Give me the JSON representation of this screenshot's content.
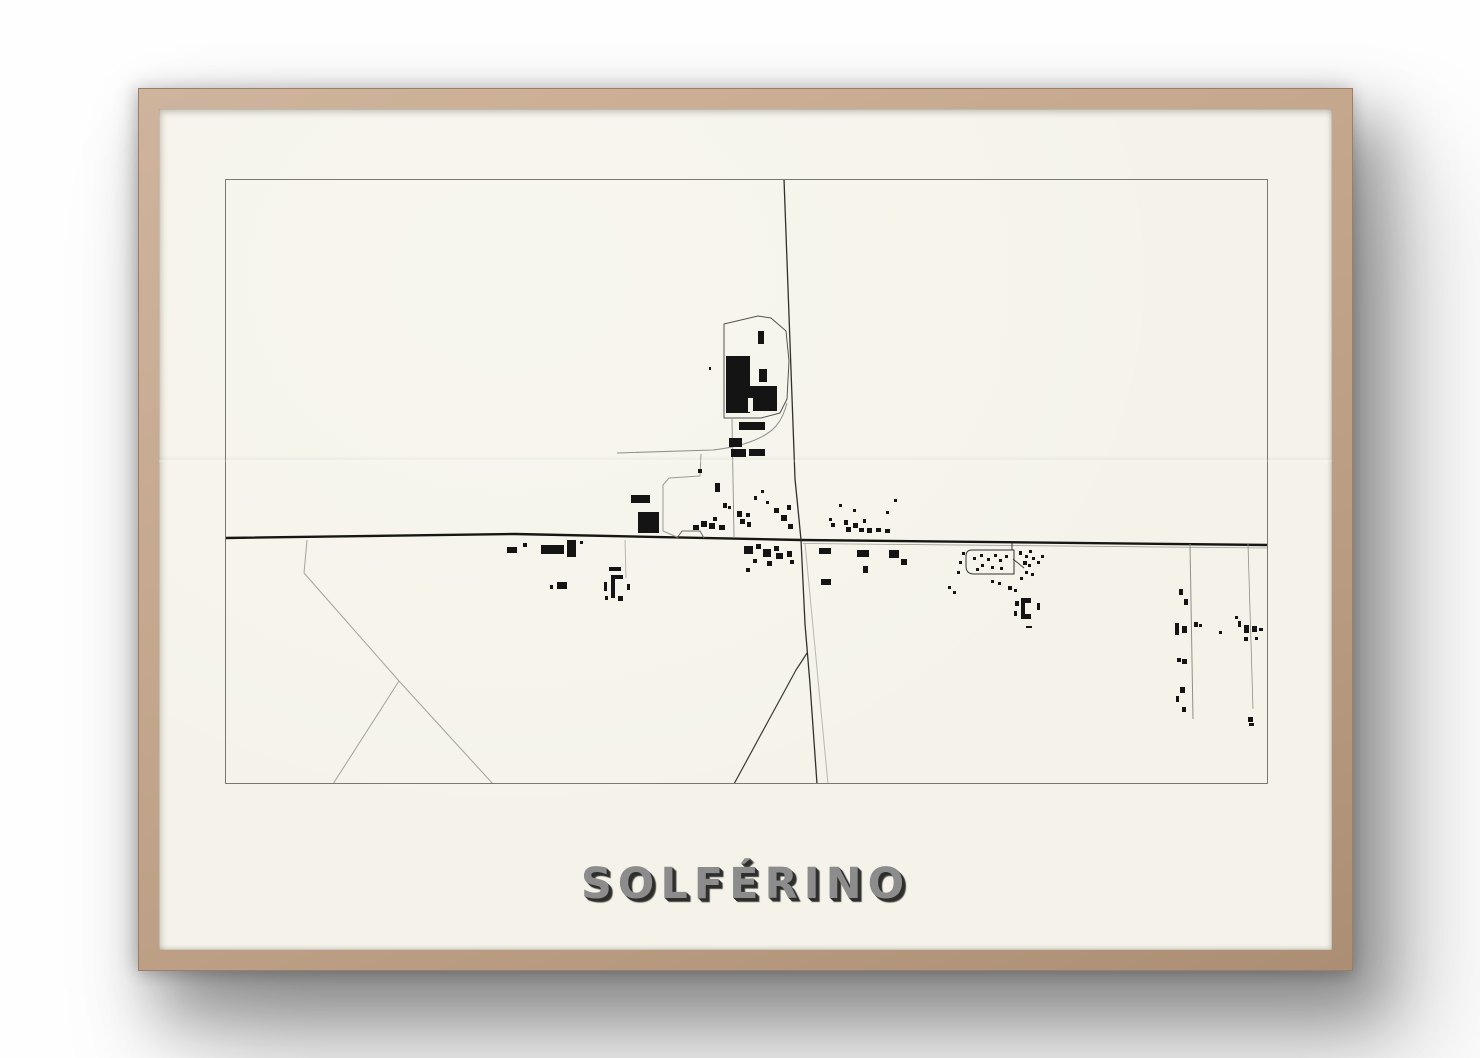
{
  "poster": {
    "title": "SOLFÉRINO"
  },
  "colors": {
    "background": "#fefefe",
    "frame_wood": "#c4a78c",
    "paper": "#f5f3e9",
    "map_border": "#7a786e",
    "road_dark": "#161613",
    "building": "#141414",
    "title_text": "#8c8c8c",
    "title_shadow": "#2e2e2c"
  },
  "map": {
    "viewbox": "0 0 1043 605",
    "paper_color": "#f5f3e9",
    "building_color": "#141414",
    "roads": [
      {
        "d": "M0,359 L290,355 L576,361 L1043,366",
        "c": "#161613",
        "w": 2.4
      },
      {
        "d": "M578,364.5 L1043,369",
        "c": "#a2a29a",
        "w": 0.8
      },
      {
        "d": "M559,0 L570,300 L573,330 L576,361",
        "c": "#30302c",
        "w": 1.3
      },
      {
        "d": "M576,361 L580,445 L585,505 L592,605",
        "c": "#30302c",
        "w": 1.3
      },
      {
        "d": "M582,474 Q577,482 571,491 L509,605",
        "c": "#3a3a35",
        "w": 1.2
      },
      {
        "d": "M580,364 L603,605",
        "c": "#b8b8b0",
        "w": 1
      },
      {
        "d": "M82,361 L79,394 L174,502 L268,605",
        "c": "#a3a399",
        "w": 1
      },
      {
        "d": "M174,502 L108,605",
        "c": "#a3a399",
        "w": 1
      },
      {
        "d": "M392,274 L488,271 C515,268 540,260 551,247 C557,240 560,232 562,224",
        "c": "#90908a",
        "w": 1
      },
      {
        "d": "M507,240 L509,359",
        "c": "#90908a",
        "w": 0.9
      },
      {
        "d": "M476,275 L475,297 L444,299 L438,306 L438,352 L452,358",
        "c": "#9c9b91",
        "w": 1
      },
      {
        "d": "M787,364 L787,371",
        "c": "#33332f",
        "w": 1
      },
      {
        "d": "M788,380 L799,389",
        "c": "#33332f",
        "w": 0.9
      },
      {
        "d": "M965,365 L968,540",
        "c": "#8f8f87",
        "w": 1
      },
      {
        "d": "M1023,365 L1028,530",
        "c": "#8f8f87",
        "w": 0.8
      },
      {
        "d": "M400,361 L401,399",
        "c": "#b0b0a8",
        "w": 0.9
      }
    ],
    "outlines": [
      {
        "d": "M0.5,0.5 H1042.5 V604.5 H0.5 Z",
        "c": "#7a786e",
        "w": 1
      },
      {
        "d": "M499,145 L533,137 L546,139 L561,152 L564,182 L562,220 L555,234 L536,239 L499,239 Z",
        "c": "#55534d",
        "w": 1
      },
      {
        "d": "M747,371 L789,371 L789,395 L749,395 Q741,395 741,387 L741,377 Q741,371 747,371 Z",
        "c": "#33332f",
        "w": 1
      },
      {
        "d": "M452,359 L457,352 L475,352 L479,359",
        "c": "#6a6a64",
        "w": 1
      }
    ],
    "shapes": [
      {
        "d": "M806,419 L796,419 L796,440 L806,440 L806,435 L800,435 L800,424 L806,424 Z"
      }
    ],
    "buildings": [
      [
        501,
        177,
        24,
        57
      ],
      [
        525,
        207,
        27,
        25
      ],
      [
        533,
        152,
        6,
        13
      ],
      [
        534,
        190,
        8,
        13
      ],
      [
        514,
        243,
        26,
        8
      ],
      [
        504,
        259,
        13,
        9
      ],
      [
        506,
        270,
        15,
        8
      ],
      [
        524,
        270,
        16,
        7
      ],
      [
        406,
        316,
        19,
        8
      ],
      [
        413,
        333,
        21,
        21
      ],
      [
        490,
        304,
        5,
        9
      ],
      [
        468,
        346,
        6,
        5
      ],
      [
        476,
        342,
        6,
        6
      ],
      [
        484,
        344,
        6,
        6
      ],
      [
        488,
        338,
        4,
        4
      ],
      [
        494,
        346,
        6,
        5
      ],
      [
        498,
        324,
        4,
        5
      ],
      [
        503,
        327,
        3,
        3
      ],
      [
        512,
        332,
        5,
        6
      ],
      [
        515,
        340,
        5,
        5
      ],
      [
        521,
        334,
        4,
        4
      ],
      [
        522,
        343,
        4,
        5
      ],
      [
        529,
        317,
        3,
        4
      ],
      [
        536,
        311,
        3,
        3
      ],
      [
        541,
        322,
        3,
        3
      ],
      [
        549,
        329,
        5,
        5
      ],
      [
        556,
        336,
        6,
        6
      ],
      [
        562,
        326,
        4,
        5
      ],
      [
        563,
        345,
        5,
        5
      ],
      [
        473,
        290,
        4,
        4
      ],
      [
        484,
        188,
        2,
        3
      ],
      [
        604,
        339,
        3,
        3
      ],
      [
        606,
        344,
        4,
        4
      ],
      [
        614,
        325,
        3,
        3
      ],
      [
        619,
        341,
        4,
        5
      ],
      [
        621,
        348,
        5,
        5
      ],
      [
        628,
        330,
        3,
        3
      ],
      [
        628,
        344,
        5,
        5
      ],
      [
        634,
        349,
        5,
        4
      ],
      [
        638,
        340,
        3,
        4
      ],
      [
        642,
        349,
        5,
        5
      ],
      [
        651,
        349,
        5,
        4
      ],
      [
        660,
        350,
        5,
        4
      ],
      [
        669,
        320,
        3,
        3
      ],
      [
        661,
        332,
        3,
        3
      ],
      [
        519,
        367,
        9,
        8
      ],
      [
        531,
        365,
        5,
        5
      ],
      [
        538,
        370,
        8,
        8
      ],
      [
        549,
        367,
        5,
        5
      ],
      [
        551,
        374,
        7,
        6
      ],
      [
        542,
        382,
        5,
        5
      ],
      [
        528,
        380,
        4,
        4
      ],
      [
        521,
        389,
        4,
        4
      ],
      [
        562,
        372,
        5,
        6
      ],
      [
        565,
        381,
        4,
        4
      ],
      [
        594,
        369,
        12,
        6
      ],
      [
        632,
        371,
        12,
        7
      ],
      [
        664,
        371,
        10,
        8
      ],
      [
        676,
        380,
        6,
        6
      ],
      [
        638,
        387,
        5,
        7
      ],
      [
        596,
        400,
        10,
        6
      ],
      [
        282,
        368,
        10,
        6
      ],
      [
        298,
        364,
        4,
        4
      ],
      [
        316,
        366,
        23,
        9
      ],
      [
        342,
        361,
        9,
        17
      ],
      [
        355,
        362,
        3,
        3
      ],
      [
        332,
        403,
        10,
        7
      ],
      [
        325,
        406,
        3,
        4
      ],
      [
        384,
        388,
        12,
        4
      ],
      [
        379,
        403,
        3,
        9
      ],
      [
        402,
        405,
        3,
        6
      ],
      [
        380,
        417,
        3,
        4
      ],
      [
        393,
        417,
        5,
        5
      ],
      [
        386,
        396,
        4,
        23
      ],
      [
        386,
        396,
        12,
        4
      ],
      [
        748,
        378,
        3,
        3
      ],
      [
        755,
        375,
        3,
        3
      ],
      [
        762,
        379,
        3,
        3
      ],
      [
        769,
        375,
        3,
        3
      ],
      [
        774,
        380,
        3,
        3
      ],
      [
        780,
        376,
        3,
        3
      ],
      [
        756,
        385,
        3,
        3
      ],
      [
        766,
        387,
        3,
        3
      ],
      [
        775,
        388,
        3,
        3
      ],
      [
        751,
        389,
        3,
        3
      ],
      [
        737,
        373,
        3,
        3
      ],
      [
        734,
        382,
        3,
        3
      ],
      [
        732,
        392,
        3,
        3
      ],
      [
        794,
        372,
        3,
        4
      ],
      [
        800,
        376,
        3,
        3
      ],
      [
        804,
        371,
        3,
        3
      ],
      [
        798,
        382,
        4,
        4
      ],
      [
        803,
        385,
        3,
        3
      ],
      [
        807,
        378,
        3,
        3
      ],
      [
        800,
        392,
        3,
        3
      ],
      [
        806,
        394,
        3,
        3
      ],
      [
        795,
        398,
        3,
        3
      ],
      [
        812,
        382,
        3,
        3
      ],
      [
        816,
        376,
        3,
        3
      ],
      [
        783,
        407,
        4,
        4
      ],
      [
        789,
        410,
        3,
        3
      ],
      [
        773,
        403,
        3,
        3
      ],
      [
        766,
        401,
        3,
        3
      ],
      [
        723,
        407,
        3,
        3
      ],
      [
        728,
        412,
        3,
        3
      ],
      [
        790,
        422,
        4,
        5
      ],
      [
        789,
        432,
        3,
        5
      ],
      [
        812,
        424,
        3,
        7
      ],
      [
        801,
        447,
        6,
        2
      ],
      [
        954,
        410,
        4,
        6
      ],
      [
        959,
        420,
        4,
        6
      ],
      [
        950,
        444,
        4,
        12
      ],
      [
        957,
        447,
        5,
        7
      ],
      [
        969,
        443,
        4,
        5
      ],
      [
        974,
        445,
        3,
        3
      ],
      [
        994,
        452,
        3,
        3
      ],
      [
        952,
        479,
        4,
        4
      ],
      [
        957,
        480,
        5,
        5
      ],
      [
        955,
        508,
        5,
        6
      ],
      [
        951,
        517,
        3,
        6
      ],
      [
        957,
        528,
        4,
        5
      ],
      [
        1013,
        442,
        3,
        6
      ],
      [
        1019,
        446,
        5,
        8
      ],
      [
        1027,
        447,
        5,
        6
      ],
      [
        1034,
        449,
        4,
        3
      ],
      [
        1019,
        458,
        4,
        4
      ],
      [
        1030,
        458,
        3,
        3
      ],
      [
        1010,
        437,
        3,
        3
      ],
      [
        1023,
        538,
        5,
        5
      ],
      [
        1024,
        544,
        5,
        3
      ]
    ],
    "white_patches": [
      [
        523,
        219,
        5,
        14
      ]
    ]
  }
}
